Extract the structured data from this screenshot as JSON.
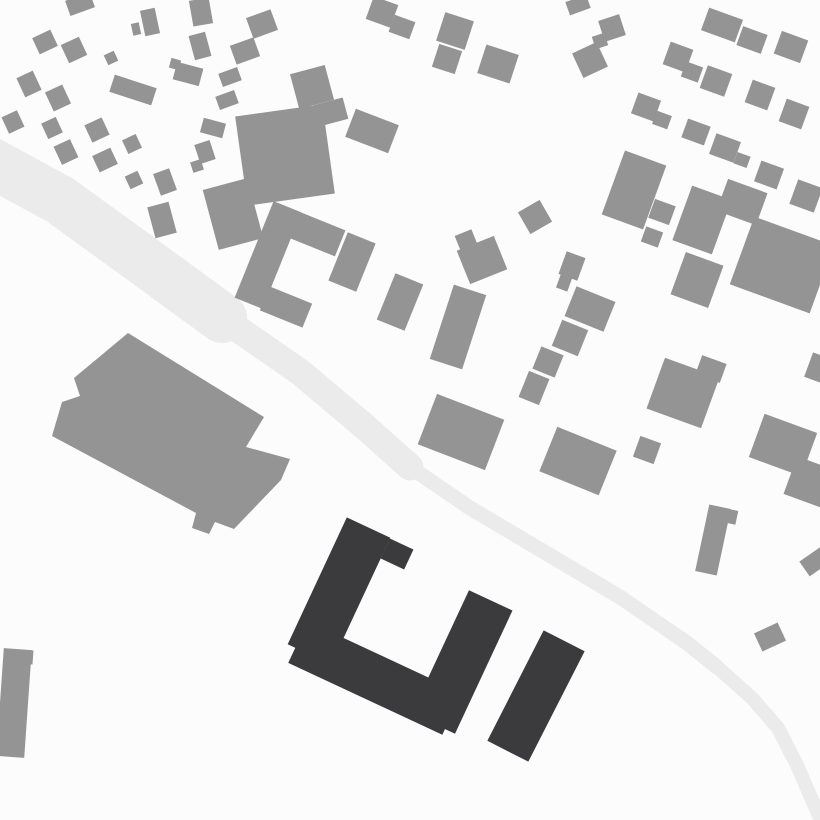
{
  "map": {
    "kind": "figure-ground-site-plan",
    "canvas": {
      "width": 820,
      "height": 820,
      "background": "#fcfcfc"
    },
    "colors": {
      "context_building": "#949494",
      "highlighted_building": "#3b3b3d",
      "road": "#ebebeb"
    },
    "road": {
      "segments": [
        {
          "width": 50,
          "points": [
            [
              -10,
              162
            ],
            [
              60,
              200
            ],
            [
              140,
              258
            ],
            [
              222,
              318
            ]
          ]
        },
        {
          "width": 27,
          "points": [
            [
              222,
              318
            ],
            [
              300,
              372
            ],
            [
              364,
              426
            ],
            [
              410,
              467
            ]
          ]
        },
        {
          "width": 15,
          "points": [
            [
              410,
              467
            ],
            [
              470,
              508
            ],
            [
              546,
              553
            ],
            [
              620,
              597
            ],
            [
              687,
              643
            ],
            [
              717,
              667
            ]
          ]
        },
        {
          "width": 14,
          "points": [
            [
              717,
              667
            ],
            [
              752,
              698
            ],
            [
              778,
              728
            ],
            [
              797,
              765
            ],
            [
              812,
              800
            ],
            [
              822,
              822
            ]
          ]
        }
      ]
    },
    "large_building_polygon": [
      [
        128,
        333
      ],
      [
        264,
        417
      ],
      [
        246,
        447
      ],
      [
        290,
        459
      ],
      [
        281,
        480
      ],
      [
        234,
        529
      ],
      [
        215,
        522
      ],
      [
        209,
        534
      ],
      [
        192,
        528
      ],
      [
        196,
        513
      ],
      [
        52,
        436
      ],
      [
        62,
        402
      ],
      [
        80,
        396
      ],
      [
        74,
        378
      ]
    ],
    "context_buildings": [
      {
        "cx": 80,
        "cy": 4,
        "w": 26,
        "h": 16,
        "r": -20
      },
      {
        "cx": 150,
        "cy": 22,
        "w": 15,
        "h": 26,
        "r": -12
      },
      {
        "cx": 136,
        "cy": 29,
        "w": 8,
        "h": 12,
        "r": -12
      },
      {
        "cx": 201,
        "cy": 12,
        "w": 20,
        "h": 26,
        "r": -10
      },
      {
        "cx": 262,
        "cy": 24,
        "w": 26,
        "h": 22,
        "r": -20
      },
      {
        "cx": 45,
        "cy": 42,
        "w": 20,
        "h": 18,
        "r": -25
      },
      {
        "cx": 74,
        "cy": 50,
        "w": 20,
        "h": 20,
        "r": -25
      },
      {
        "cx": 111,
        "cy": 58,
        "w": 11,
        "h": 11,
        "r": -25
      },
      {
        "cx": 200,
        "cy": 46,
        "w": 17,
        "h": 25,
        "r": -15
      },
      {
        "cx": 245,
        "cy": 51,
        "w": 25,
        "h": 20,
        "r": -20
      },
      {
        "cx": 29,
        "cy": 84,
        "w": 18,
        "h": 21,
        "r": -25
      },
      {
        "cx": 58,
        "cy": 98,
        "w": 19,
        "h": 21,
        "r": -25
      },
      {
        "cx": 133,
        "cy": 90,
        "w": 44,
        "h": 18,
        "r": 18
      },
      {
        "cx": 188,
        "cy": 74,
        "w": 27,
        "h": 18,
        "r": 15
      },
      {
        "cx": 175,
        "cy": 64,
        "w": 10,
        "h": 10,
        "r": 15
      },
      {
        "cx": 230,
        "cy": 77,
        "w": 20,
        "h": 14,
        "r": -20
      },
      {
        "cx": 227,
        "cy": 100,
        "w": 20,
        "h": 14,
        "r": -20
      },
      {
        "cx": 13,
        "cy": 122,
        "w": 17,
        "h": 18,
        "r": -25
      },
      {
        "cx": 52,
        "cy": 128,
        "w": 16,
        "h": 17,
        "r": -25
      },
      {
        "cx": 97,
        "cy": 130,
        "w": 19,
        "h": 19,
        "r": -25
      },
      {
        "cx": 132,
        "cy": 144,
        "w": 15,
        "h": 15,
        "r": -25
      },
      {
        "cx": 213,
        "cy": 128,
        "w": 23,
        "h": 15,
        "r": 15
      },
      {
        "cx": 205,
        "cy": 152,
        "w": 16,
        "h": 20,
        "r": -18
      },
      {
        "cx": 197,
        "cy": 166,
        "w": 11,
        "h": 11,
        "r": -18
      },
      {
        "cx": 66,
        "cy": 152,
        "w": 18,
        "h": 20,
        "r": -25
      },
      {
        "cx": 105,
        "cy": 160,
        "w": 20,
        "h": 18,
        "r": -25
      },
      {
        "cx": 134,
        "cy": 180,
        "w": 14,
        "h": 14,
        "r": -25
      },
      {
        "cx": 165,
        "cy": 182,
        "w": 17,
        "h": 23,
        "r": -20
      },
      {
        "cx": 233,
        "cy": 214,
        "w": 46,
        "h": 62,
        "r": -15
      },
      {
        "cx": 162,
        "cy": 220,
        "w": 22,
        "h": 32,
        "r": -15
      },
      {
        "cx": 312,
        "cy": 87,
        "w": 36,
        "h": 36,
        "r": -15
      },
      {
        "cx": 331,
        "cy": 112,
        "w": 30,
        "h": 22,
        "r": -15
      },
      {
        "cx": 285,
        "cy": 155,
        "w": 88,
        "h": 90,
        "r": -8
      },
      {
        "cx": 372,
        "cy": 131,
        "w": 46,
        "h": 30,
        "r": 21
      },
      {
        "cx": 382,
        "cy": 12,
        "w": 26,
        "h": 24,
        "r": 20
      },
      {
        "cx": 402,
        "cy": 27,
        "w": 22,
        "h": 18,
        "r": 20
      },
      {
        "cx": 455,
        "cy": 31,
        "w": 30,
        "h": 30,
        "r": 18
      },
      {
        "cx": 447,
        "cy": 59,
        "w": 24,
        "h": 24,
        "r": 18
      },
      {
        "cx": 498,
        "cy": 64,
        "w": 34,
        "h": 30,
        "r": 18
      },
      {
        "cx": 268,
        "cy": 255,
        "w": 30,
        "h": 104,
        "r": 22
      },
      {
        "cx": 317,
        "cy": 234,
        "w": 50,
        "h": 28,
        "r": 22
      },
      {
        "cx": 286,
        "cy": 307,
        "w": 46,
        "h": 26,
        "r": 22
      },
      {
        "cx": 352,
        "cy": 262,
        "w": 30,
        "h": 52,
        "r": 22
      },
      {
        "cx": 400,
        "cy": 302,
        "w": 30,
        "h": 50,
        "r": 22
      },
      {
        "cx": 458,
        "cy": 327,
        "w": 34,
        "h": 78,
        "r": 18
      },
      {
        "cx": 461,
        "cy": 432,
        "w": 72,
        "h": 54,
        "r": 21
      },
      {
        "cx": 482,
        "cy": 260,
        "w": 40,
        "h": 36,
        "r": -22
      },
      {
        "cx": 466,
        "cy": 240,
        "w": 18,
        "h": 16,
        "r": -22
      },
      {
        "cx": 535,
        "cy": 217,
        "w": 25,
        "h": 25,
        "r": -30
      },
      {
        "cx": 572,
        "cy": 266,
        "w": 20,
        "h": 24,
        "r": 20
      },
      {
        "cx": 564,
        "cy": 283,
        "w": 12,
        "h": 14,
        "r": 20
      },
      {
        "cx": 590,
        "cy": 309,
        "w": 42,
        "h": 32,
        "r": 22
      },
      {
        "cx": 570,
        "cy": 338,
        "w": 28,
        "h": 28,
        "r": 22
      },
      {
        "cx": 548,
        "cy": 362,
        "w": 24,
        "h": 24,
        "r": 22
      },
      {
        "cx": 534,
        "cy": 388,
        "w": 22,
        "h": 28,
        "r": 22
      },
      {
        "cx": 578,
        "cy": 5,
        "w": 22,
        "h": 14,
        "r": -20
      },
      {
        "cx": 612,
        "cy": 28,
        "w": 22,
        "h": 22,
        "r": -18
      },
      {
        "cx": 600,
        "cy": 41,
        "w": 13,
        "h": 13,
        "r": -18
      },
      {
        "cx": 590,
        "cy": 60,
        "w": 27,
        "h": 27,
        "r": -25
      },
      {
        "cx": 722,
        "cy": 25,
        "w": 36,
        "h": 24,
        "r": 20
      },
      {
        "cx": 752,
        "cy": 40,
        "w": 26,
        "h": 20,
        "r": 20
      },
      {
        "cx": 791,
        "cy": 47,
        "w": 28,
        "h": 24,
        "r": 20
      },
      {
        "cx": 678,
        "cy": 57,
        "w": 24,
        "h": 24,
        "r": 20
      },
      {
        "cx": 692,
        "cy": 72,
        "w": 18,
        "h": 16,
        "r": 20
      },
      {
        "cx": 716,
        "cy": 81,
        "w": 26,
        "h": 24,
        "r": 20
      },
      {
        "cx": 760,
        "cy": 95,
        "w": 24,
        "h": 24,
        "r": 20
      },
      {
        "cx": 794,
        "cy": 114,
        "w": 24,
        "h": 24,
        "r": 20
      },
      {
        "cx": 646,
        "cy": 107,
        "w": 24,
        "h": 22,
        "r": 20
      },
      {
        "cx": 662,
        "cy": 120,
        "w": 16,
        "h": 14,
        "r": 20
      },
      {
        "cx": 696,
        "cy": 132,
        "w": 24,
        "h": 20,
        "r": 20
      },
      {
        "cx": 725,
        "cy": 148,
        "w": 26,
        "h": 22,
        "r": 20
      },
      {
        "cx": 742,
        "cy": 160,
        "w": 14,
        "h": 12,
        "r": 20
      },
      {
        "cx": 769,
        "cy": 175,
        "w": 24,
        "h": 22,
        "r": 20
      },
      {
        "cx": 806,
        "cy": 196,
        "w": 26,
        "h": 26,
        "r": 20
      },
      {
        "cx": 634,
        "cy": 190,
        "w": 44,
        "h": 68,
        "r": 20
      },
      {
        "cx": 662,
        "cy": 212,
        "w": 22,
        "h": 20,
        "r": 20
      },
      {
        "cx": 652,
        "cy": 237,
        "w": 18,
        "h": 16,
        "r": 20
      },
      {
        "cx": 702,
        "cy": 220,
        "w": 42,
        "h": 58,
        "r": 20
      },
      {
        "cx": 742,
        "cy": 202,
        "w": 42,
        "h": 34,
        "r": 20
      },
      {
        "cx": 782,
        "cy": 265,
        "w": 85,
        "h": 72,
        "r": 20
      },
      {
        "cx": 697,
        "cy": 280,
        "w": 40,
        "h": 45,
        "r": 20
      },
      {
        "cx": 818,
        "cy": 368,
        "w": 20,
        "h": 26,
        "r": 20
      },
      {
        "cx": 683,
        "cy": 393,
        "w": 58,
        "h": 54,
        "r": 20
      },
      {
        "cx": 711,
        "cy": 369,
        "w": 26,
        "h": 20,
        "r": 20
      },
      {
        "cx": 647,
        "cy": 450,
        "w": 22,
        "h": 22,
        "r": 20
      },
      {
        "cx": 578,
        "cy": 461,
        "w": 64,
        "h": 48,
        "r": 22
      },
      {
        "cx": 783,
        "cy": 445,
        "w": 56,
        "h": 46,
        "r": 20
      },
      {
        "cx": 812,
        "cy": 483,
        "w": 46,
        "h": 40,
        "r": 20
      },
      {
        "cx": 713,
        "cy": 540,
        "w": 22,
        "h": 68,
        "r": 12
      },
      {
        "cx": 728,
        "cy": 516,
        "w": 18,
        "h": 14,
        "r": 12
      },
      {
        "cx": 770,
        "cy": 637,
        "w": 26,
        "h": 20,
        "r": -25
      },
      {
        "cx": 816,
        "cy": 561,
        "w": 28,
        "h": 18,
        "r": -35
      },
      {
        "cx": 14,
        "cy": 703,
        "w": 28,
        "h": 108,
        "r": 4
      },
      {
        "cx": 26,
        "cy": 657,
        "w": 14,
        "h": 14,
        "r": 4
      }
    ],
    "highlighted_buildings": [
      {
        "cx": 339,
        "cy": 591,
        "w": 48,
        "h": 140,
        "r": 25
      },
      {
        "cx": 375,
        "cy": 678,
        "w": 170,
        "h": 46,
        "r": 25
      },
      {
        "cx": 462,
        "cy": 662,
        "w": 48,
        "h": 136,
        "r": 25
      },
      {
        "cx": 397,
        "cy": 554,
        "w": 26,
        "h": 22,
        "r": 25
      },
      {
        "cx": 536,
        "cy": 696,
        "w": 46,
        "h": 124,
        "r": 27
      }
    ]
  }
}
